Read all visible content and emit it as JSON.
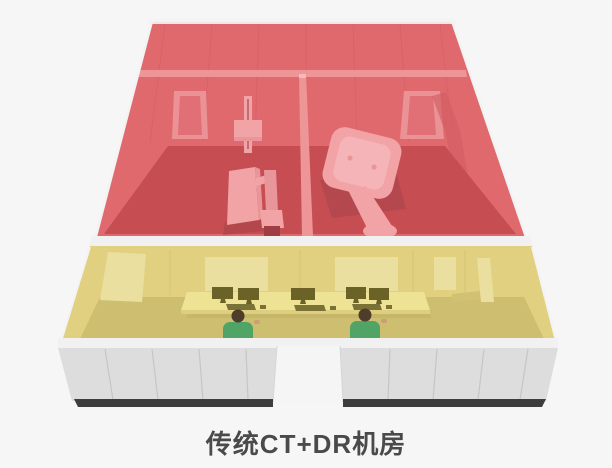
{
  "title": "传统CT+DR机房",
  "colors": {
    "background": "#f6f6f6",
    "edge_white": "#f3f3f3",
    "red_wall": "#e0696e",
    "red_wall_light": "#ee9598",
    "red_wall_lighter": "#f5b8bb",
    "red_door": "#ea9296",
    "red_door_inner": "#e07075",
    "red_floor": "#c64d52",
    "red_shadow": "#a8444a",
    "red_seam": "#cf5a60",
    "red_recess": "#d25d63",
    "machine_pink": "#f1a3a6",
    "machine_pink_light": "#f5b5b8",
    "machine_pink_shade": "#e8969a",
    "machine_slot": "#c26d74",
    "machine_base": "#9e3d43",
    "yellow_wall": "#e0d080",
    "yellow_wall_light": "#eadf9e",
    "yellow_wall_dark": "#d2c172",
    "yellow_floor": "#cdbe70",
    "yellow_seam": "#c8b768",
    "desk": "#eee295",
    "desk_edge": "#ddcf7e",
    "desk_shadow": "#bcab60",
    "monitor": "#6a6226",
    "keyboard": "#7a7136",
    "person_shirt": "#4fa466",
    "person_hair": "#4e3d2a",
    "person_skin": "#c9a171",
    "white_wall": "#dddddd",
    "white_wall_top": "#f1f1f1",
    "wall_seam": "#c2c2c2",
    "door_opening": "#f5f5f5",
    "door_jamb": "#d6d6d6",
    "base_dark": "#3d3d3d",
    "title_color": "#4a4a4a"
  }
}
